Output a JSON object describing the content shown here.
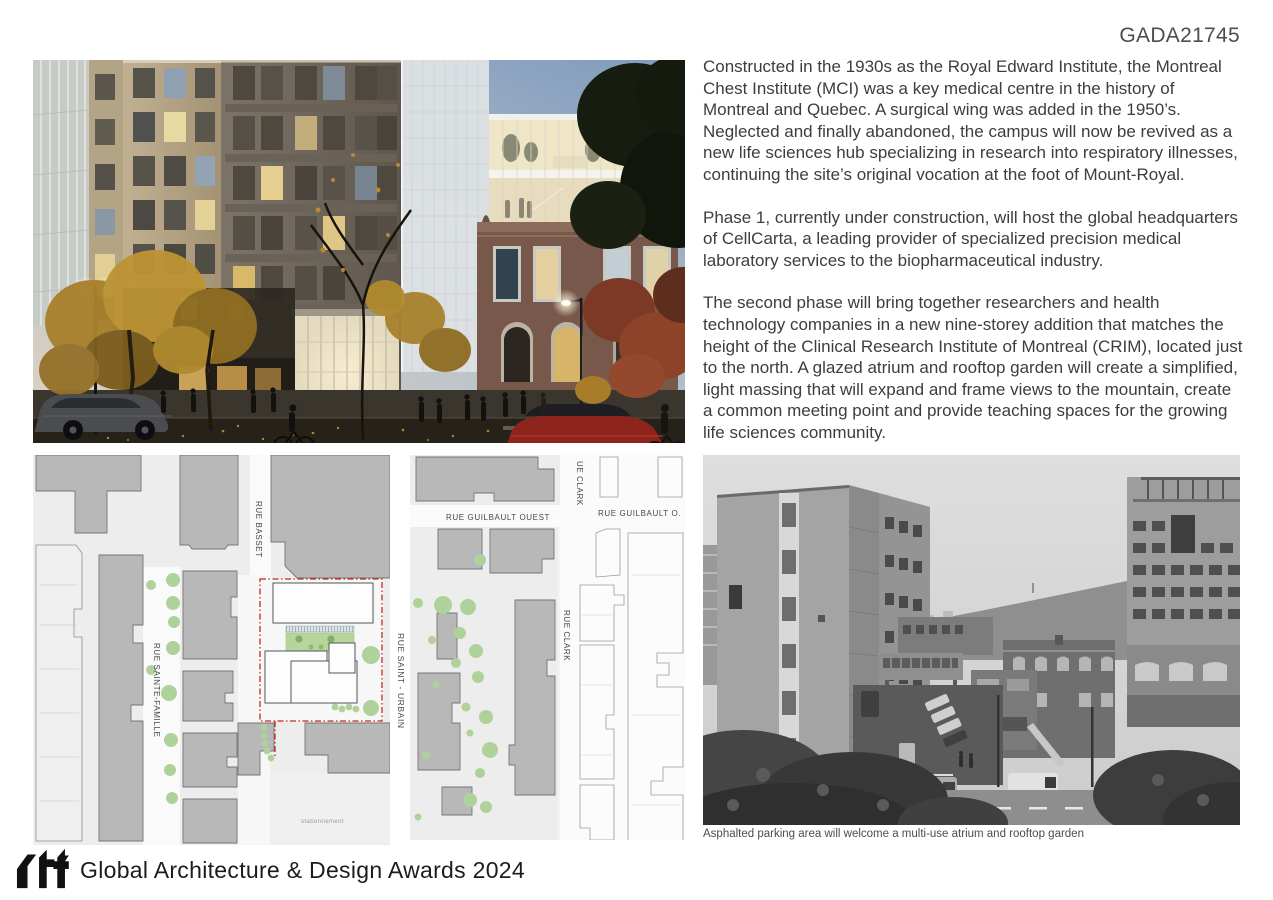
{
  "page": {
    "submission_code": "GADA21745"
  },
  "description": {
    "paragraphs": [
      "Constructed in the 1930s as the Royal Edward Institute, the Montreal Chest Institute (MCI) was a key medical centre in the history of Montreal and Quebec. A surgical wing was added in the 1950’s. Neglected and finally abandoned, the campus will now be revived as a new life sciences hub specializing in research into respiratory illnesses, continuing the site’s original vocation at the foot of Mount-Royal.",
      "Phase 1, currently under construction, will host the global headquarters of CellCarta, a leading provider of specialized precision medical laboratory services to the biopharmaceutical industry.",
      "The second phase will bring together researchers and health technology companies in a new nine-storey addition that matches the height of the Clinical Research Institute of Montreal (CRIM), located just to the north.  A glazed atrium and rooftop garden will create a simplified, light massing that will expand and frame views to the mountain, create a common meeting point and provide teaching spaces for the growing life sciences community."
    ]
  },
  "site_plans": {
    "left": {
      "streets": {
        "basset": "RUE BASSET",
        "sainte_famille": "RUE SAINTE-FAMILLE",
        "saint_urbain": "RUE SAINT - URBAIN"
      },
      "area_label": "stationnement"
    },
    "right": {
      "streets": {
        "guilbault_ouest": "RUE  GUILBAULT OUEST",
        "guilbault_o": "RUE  GUILBAULT O.",
        "clark_top": "UE  CLARK",
        "clark": "RUE CLARK"
      }
    }
  },
  "historic_photo": {
    "caption": "Asphalted parking area will welcome a multi-use atrium and rooftop garden"
  },
  "footer": {
    "logo_text": "rtf",
    "award_title": "Global Architecture & Design Awards 2024"
  },
  "colors": {
    "site_boundary_red": "#c4281c",
    "plan_green": "#aed29a",
    "body_text": "#3d3d3d"
  }
}
